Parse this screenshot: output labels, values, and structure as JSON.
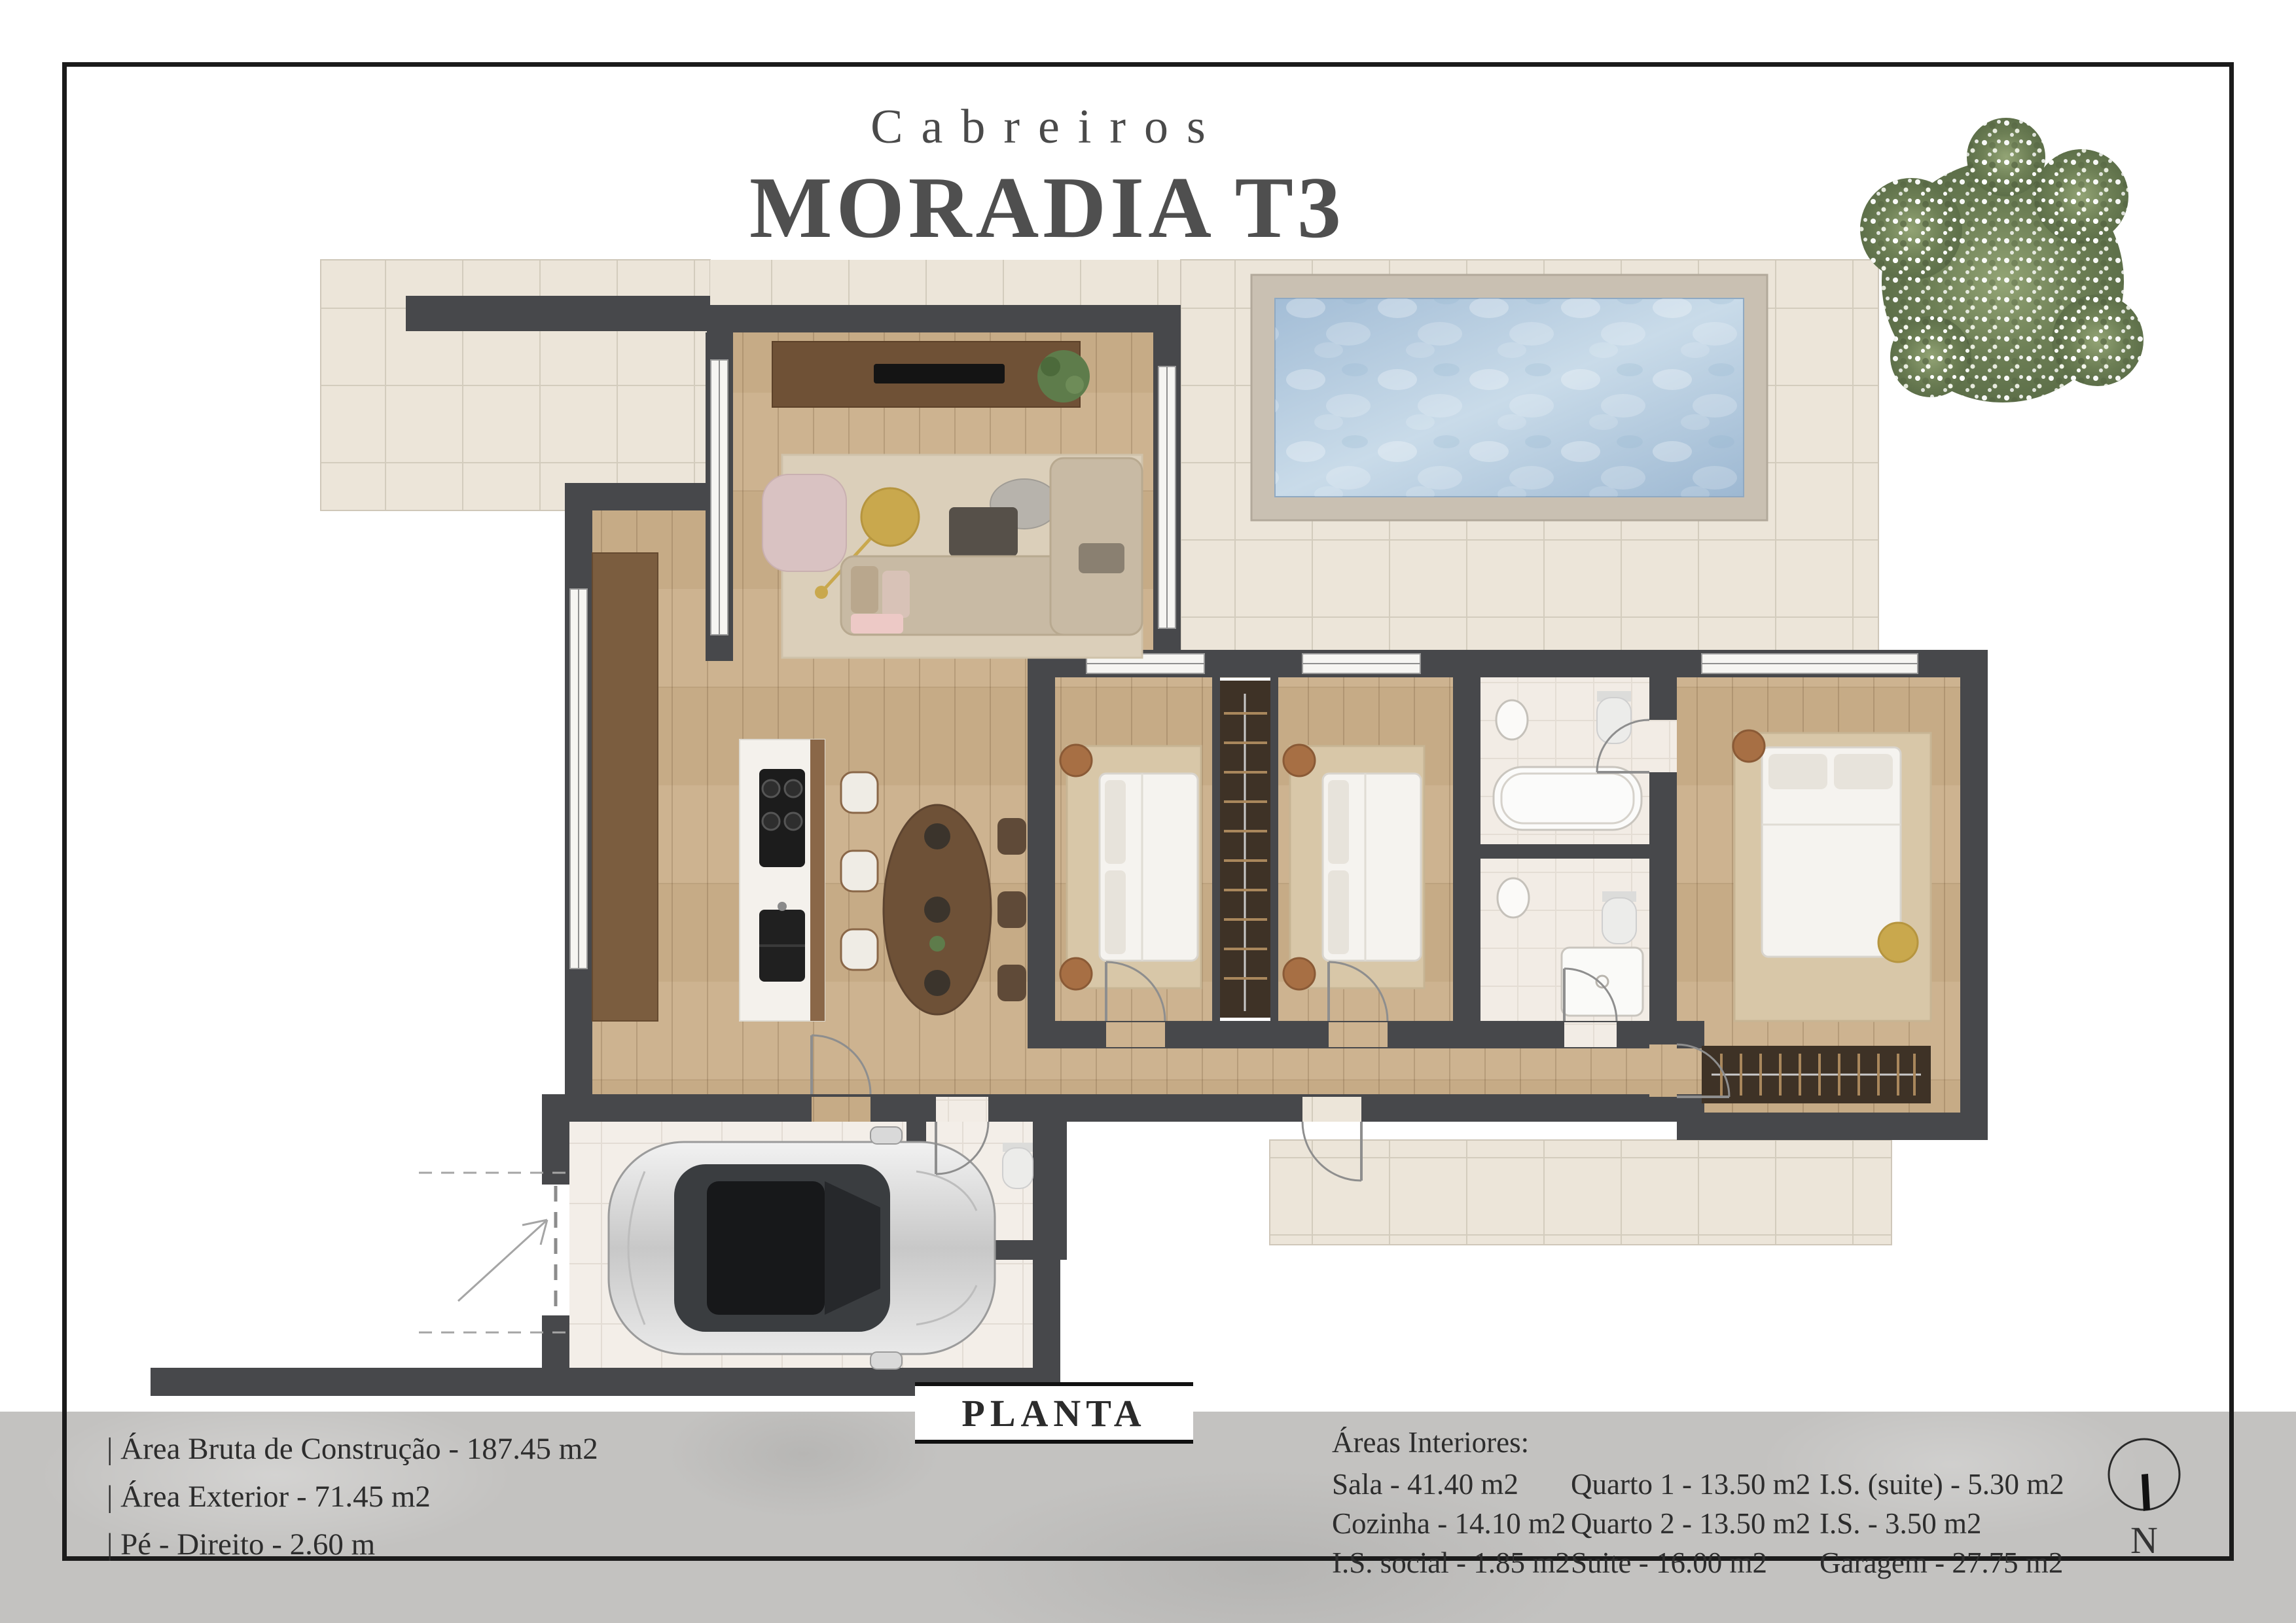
{
  "title": {
    "project": "Cabreiros",
    "name": "MORADIA T3"
  },
  "plan": {
    "label": "PLANTA",
    "compass_label": "N"
  },
  "specs": {
    "items": [
      "| Área Bruta de Construção - 187.45 m2",
      "| Área Exterior - 71.45 m2",
      "| Pé - Direito - 2.60 m"
    ]
  },
  "areas": {
    "heading": "Áreas Interiores:",
    "columns": [
      [
        "Sala - 41.40 m2",
        "Cozinha - 14.10 m2",
        "I.S. social - 1.85 m2"
      ],
      [
        "Quarto 1 - 13.50 m2",
        "Quarto 2 - 13.50 m2",
        "Suite - 16.00 m2"
      ],
      [
        "I.S. (suite) - 5.30 m2",
        "I.S. - 3.50 m2",
        "Garagem - 27.75 m2"
      ]
    ]
  },
  "colors": {
    "wall": "#47484b",
    "wood": "#cdb390",
    "tile": "#ece5d9",
    "water": "#a9c2d8",
    "pool_deck": "#c9c0b2",
    "gold": "#c9a84d",
    "band": "#c3c2c0",
    "ink": "#2e2e2e",
    "title_ink": "#4f4f4f"
  }
}
